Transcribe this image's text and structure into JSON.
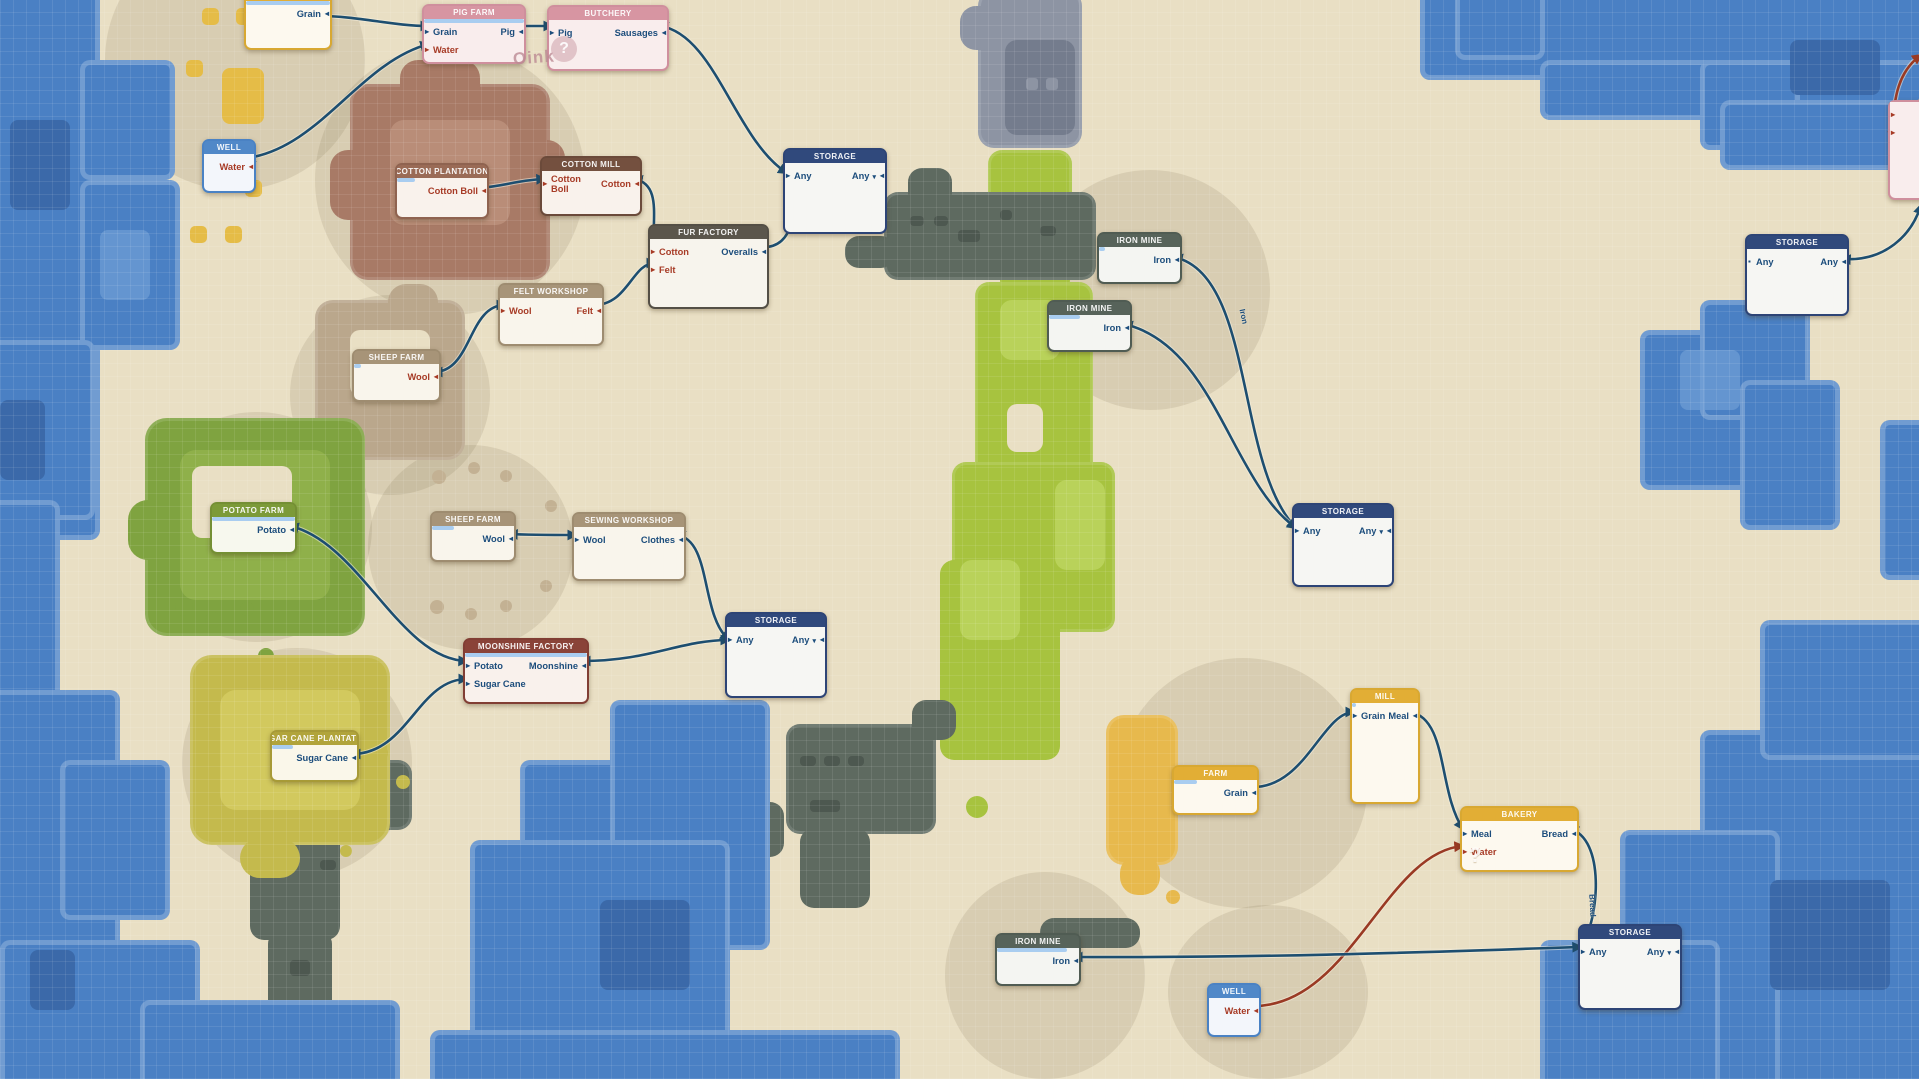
{
  "easter_egg": {
    "oink_text": "Oink",
    "oink_mark": "?"
  },
  "colors": {
    "line_navy": "#1d4e70",
    "line_red": "#9a3a24",
    "item_navy": "#1c4d7c",
    "item_red": "#a73b26",
    "progress": "#a9cdf0",
    "water": "#4a80c4",
    "land": "#e9dfc4",
    "themes": {
      "yellow": {
        "header": "#e2ae35",
        "border": "#d8a832",
        "body": "#fdf9ef"
      },
      "rose": {
        "header": "#d795a2",
        "border": "#cf8f9d",
        "body": "#f9eded"
      },
      "blue": {
        "header": "#5088c8",
        "border": "#4a82c4",
        "body": "#f3f6fb"
      },
      "brown": {
        "header": "#9a6b56",
        "border": "#8f6350",
        "body": "#f9f2ec"
      },
      "darkbrown": {
        "header": "#74503f",
        "border": "#6b4a3a",
        "body": "#f9f2ec"
      },
      "taupe": {
        "header": "#5b564c",
        "border": "#544f46",
        "body": "#f7f4ed"
      },
      "tan": {
        "header": "#a79478",
        "border": "#9e8c70",
        "body": "#f9f5ec"
      },
      "storage": {
        "header": "#30497c",
        "border": "#2d4476",
        "body": "#f6f6f3"
      },
      "iron": {
        "header": "#57635a",
        "border": "#505c53",
        "body": "#f4f5f2"
      },
      "olive": {
        "header": "#7c9a38",
        "border": "#748f34",
        "body": "#f7f8ee"
      },
      "maroon": {
        "header": "#8a4338",
        "border": "#813e34",
        "body": "#f9f1ec"
      },
      "gold": {
        "header": "#b1a43b",
        "border": "#a79a37",
        "body": "#faf7ea"
      }
    }
  },
  "nodes": [
    {
      "id": "farm-top",
      "title": "FARM",
      "theme": "yellow",
      "x": 244,
      "y": -14,
      "w": 84,
      "h": 60,
      "progress": 1,
      "rows": [
        {
          "out": {
            "label": "Grain",
            "color": "navy"
          }
        }
      ]
    },
    {
      "id": "pig-farm",
      "title": "PIG FARM",
      "theme": "rose",
      "x": 422,
      "y": 4,
      "w": 100,
      "h": 56,
      "progress": 1,
      "rows": [
        {
          "in": {
            "label": "Grain",
            "color": "navy"
          },
          "out": {
            "label": "Pig",
            "color": "navy"
          }
        },
        {
          "in": {
            "label": "Water",
            "color": "red"
          }
        }
      ]
    },
    {
      "id": "butchery",
      "title": "BUTCHERY",
      "theme": "rose",
      "x": 547,
      "y": 5,
      "w": 118,
      "h": 62,
      "rows": [
        {
          "in": {
            "label": "Pig",
            "color": "navy"
          },
          "out": {
            "label": "Sausages",
            "color": "navy"
          }
        }
      ]
    },
    {
      "id": "well-top",
      "title": "WELL",
      "theme": "blue",
      "x": 202,
      "y": 139,
      "w": 50,
      "h": 50,
      "rows": [
        {
          "out": {
            "label": "Water",
            "color": "red"
          }
        }
      ]
    },
    {
      "id": "cotton-plantation",
      "title": "COTTON PLANTATION",
      "theme": "brown",
      "x": 395,
      "y": 163,
      "w": 90,
      "h": 52,
      "progress": 0.2,
      "rows": [
        {
          "out": {
            "label": "Cotton Boll",
            "color": "red"
          }
        }
      ]
    },
    {
      "id": "cotton-mill",
      "title": "COTTON MILL",
      "theme": "darkbrown",
      "x": 540,
      "y": 156,
      "w": 98,
      "h": 56,
      "rows": [
        {
          "in": {
            "label": "Cotton Boll",
            "color": "red"
          },
          "out": {
            "label": "Cotton",
            "color": "red"
          }
        }
      ]
    },
    {
      "id": "fur-factory",
      "title": "FUR FACTORY",
      "theme": "taupe",
      "x": 648,
      "y": 224,
      "w": 117,
      "h": 81,
      "rows": [
        {
          "in": {
            "label": "Cotton",
            "color": "red"
          },
          "out": {
            "label": "Overalls",
            "color": "navy"
          }
        },
        {
          "in": {
            "label": "Felt",
            "color": "red"
          }
        }
      ]
    },
    {
      "id": "felt-workshop",
      "title": "FELT WORKSHOP",
      "theme": "tan",
      "x": 498,
      "y": 283,
      "w": 102,
      "h": 59,
      "rows": [
        {
          "in": {
            "label": "Wool",
            "color": "red"
          },
          "out": {
            "label": "Felt",
            "color": "red"
          }
        }
      ]
    },
    {
      "id": "sheep-farm-1",
      "title": "SHEEP FARM",
      "theme": "tan",
      "x": 352,
      "y": 349,
      "w": 85,
      "h": 49,
      "progress": 0.08,
      "rows": [
        {
          "out": {
            "label": "Wool",
            "color": "red"
          }
        }
      ]
    },
    {
      "id": "storage-top",
      "title": "STORAGE",
      "theme": "storage",
      "x": 783,
      "y": 148,
      "w": 100,
      "h": 82,
      "rows": [
        {
          "in": {
            "label": "Any",
            "color": "navy"
          },
          "out": {
            "label": "Any",
            "color": "navy",
            "dropdown": true
          }
        }
      ]
    },
    {
      "id": "iron-mine-1",
      "title": "IRON MINE",
      "theme": "iron",
      "x": 1097,
      "y": 232,
      "w": 81,
      "h": 48,
      "progress": 0.07,
      "rows": [
        {
          "out": {
            "label": "Iron",
            "color": "navy"
          }
        }
      ]
    },
    {
      "id": "iron-mine-2",
      "title": "IRON MINE",
      "theme": "iron",
      "x": 1047,
      "y": 300,
      "w": 81,
      "h": 48,
      "progress": 0.38,
      "rows": [
        {
          "out": {
            "label": "Iron",
            "color": "navy"
          }
        }
      ]
    },
    {
      "id": "storage-right",
      "title": "STORAGE",
      "theme": "storage",
      "x": 1292,
      "y": 503,
      "w": 98,
      "h": 80,
      "rows": [
        {
          "in": {
            "label": "Any",
            "color": "navy"
          },
          "out": {
            "label": "Any",
            "color": "navy",
            "dropdown": true
          }
        }
      ]
    },
    {
      "id": "storage-far-right",
      "title": "STORAGE",
      "theme": "storage",
      "x": 1745,
      "y": 234,
      "w": 100,
      "h": 78,
      "rows": [
        {
          "in": {
            "label": "Any",
            "color": "navy",
            "bullet": "square"
          },
          "out": {
            "label": "Any",
            "color": "navy"
          }
        }
      ]
    },
    {
      "id": "potato-farm",
      "title": "POTATO FARM",
      "theme": "olive",
      "x": 210,
      "y": 502,
      "w": 83,
      "h": 48,
      "progress": 1,
      "rows": [
        {
          "out": {
            "label": "Potato",
            "color": "navy"
          }
        }
      ]
    },
    {
      "id": "sheep-farm-2",
      "title": "SHEEP FARM",
      "theme": "tan",
      "x": 430,
      "y": 511,
      "w": 82,
      "h": 47,
      "progress": 0.27,
      "rows": [
        {
          "out": {
            "label": "Wool",
            "color": "navy"
          }
        }
      ]
    },
    {
      "id": "sewing-workshop",
      "title": "SEWING WORKSHOP",
      "theme": "tan",
      "x": 572,
      "y": 512,
      "w": 110,
      "h": 65,
      "rows": [
        {
          "in": {
            "label": "Wool",
            "color": "navy"
          },
          "out": {
            "label": "Clothes",
            "color": "navy"
          }
        }
      ]
    },
    {
      "id": "moonshine-factory",
      "title": "MOONSHINE FACTORY",
      "theme": "maroon",
      "x": 463,
      "y": 638,
      "w": 122,
      "h": 62,
      "progress": 1,
      "rows": [
        {
          "in": {
            "label": "Potato",
            "color": "navy"
          },
          "out": {
            "label": "Moonshine",
            "color": "navy"
          }
        },
        {
          "in": {
            "label": "Sugar Cane",
            "color": "navy"
          }
        }
      ]
    },
    {
      "id": "sugar-cane-plantation",
      "title": "SUGAR CANE PLANTATION",
      "theme": "gold",
      "x": 270,
      "y": 730,
      "w": 85,
      "h": 48,
      "progress": 0.25,
      "rows": [
        {
          "out": {
            "label": "Sugar Cane",
            "color": "navy"
          }
        }
      ]
    },
    {
      "id": "storage-center",
      "title": "STORAGE",
      "theme": "storage",
      "x": 725,
      "y": 612,
      "w": 98,
      "h": 82,
      "rows": [
        {
          "in": {
            "label": "Any",
            "color": "navy"
          },
          "out": {
            "label": "Any",
            "color": "navy",
            "dropdown": true
          }
        }
      ]
    },
    {
      "id": "mill",
      "title": "MILL",
      "theme": "yellow",
      "x": 1350,
      "y": 688,
      "w": 66,
      "h": 112,
      "progress": 0.06,
      "rows": [
        {
          "in": {
            "label": "Grain",
            "color": "navy"
          },
          "out": {
            "label": "Meal",
            "color": "navy"
          }
        }
      ]
    },
    {
      "id": "farm-bottom",
      "title": "FARM",
      "theme": "yellow",
      "x": 1172,
      "y": 765,
      "w": 83,
      "h": 46,
      "progress": 0.28,
      "rows": [
        {
          "out": {
            "label": "Grain",
            "color": "navy"
          }
        }
      ]
    },
    {
      "id": "bakery",
      "title": "BAKERY",
      "theme": "yellow",
      "x": 1460,
      "y": 806,
      "w": 115,
      "h": 62,
      "ghost": "?",
      "rows": [
        {
          "in": {
            "label": "Meal",
            "color": "navy"
          },
          "out": {
            "label": "Bread",
            "color": "navy"
          }
        },
        {
          "in": {
            "label": "Water",
            "color": "red"
          }
        }
      ]
    },
    {
      "id": "storage-bottom-right",
      "title": "STORAGE",
      "theme": "storage",
      "x": 1578,
      "y": 924,
      "w": 100,
      "h": 82,
      "rows": [
        {
          "in": {
            "label": "Any",
            "color": "navy"
          },
          "out": {
            "label": "Any",
            "color": "navy",
            "dropdown": true
          }
        }
      ]
    },
    {
      "id": "iron-mine-3",
      "title": "IRON MINE",
      "theme": "iron",
      "x": 995,
      "y": 933,
      "w": 82,
      "h": 49,
      "progress": 0.85,
      "rows": [
        {
          "out": {
            "label": "Iron",
            "color": "navy"
          }
        }
      ]
    },
    {
      "id": "well-bottom",
      "title": "WELL",
      "theme": "blue",
      "x": 1207,
      "y": 983,
      "w": 50,
      "h": 50,
      "rows": [
        {
          "out": {
            "label": "Water",
            "color": "red"
          }
        }
      ]
    },
    {
      "id": "edge-node",
      "title": "",
      "theme": "rose",
      "x": 1888,
      "y": 100,
      "w": 64,
      "h": 96,
      "rows": [
        {
          "in": {
            "label": "",
            "color": "red"
          }
        },
        {
          "in": {
            "label": "",
            "color": "red"
          }
        }
      ]
    }
  ],
  "connections": [
    {
      "id": "farm-grain-to-pigfarm",
      "from": [
        318,
        16
      ],
      "c1": [
        360,
        16
      ],
      "c2": [
        392,
        26
      ],
      "to": [
        429,
        26
      ],
      "color": "navy"
    },
    {
      "id": "well-water-to-pigfarm",
      "from": [
        247,
        158
      ],
      "c1": [
        320,
        148
      ],
      "c2": [
        360,
        62
      ],
      "to": [
        429,
        44
      ],
      "color": "navy"
    },
    {
      "id": "pig-to-butchery",
      "from": [
        517,
        26
      ],
      "c1": [
        530,
        26
      ],
      "c2": [
        540,
        26
      ],
      "to": [
        552,
        26
      ],
      "color": "navy"
    },
    {
      "id": "sausages-to-storage",
      "from": [
        660,
        26
      ],
      "c1": [
        715,
        34
      ],
      "c2": [
        735,
        140
      ],
      "to": [
        787,
        173
      ],
      "color": "navy"
    },
    {
      "id": "cottonboll-to-mill",
      "from": [
        479,
        188
      ],
      "c1": [
        505,
        186
      ],
      "c2": [
        518,
        180
      ],
      "to": [
        545,
        179
      ],
      "color": "navy"
    },
    {
      "id": "cotton-to-furfactory",
      "from": [
        634,
        179
      ],
      "c1": [
        664,
        184
      ],
      "c2": [
        650,
        225
      ],
      "to": [
        655,
        247
      ],
      "color": "navy"
    },
    {
      "id": "felt-to-furfactory",
      "from": [
        594,
        305
      ],
      "c1": [
        628,
        305
      ],
      "c2": [
        632,
        263
      ],
      "to": [
        655,
        263
      ],
      "color": "navy"
    },
    {
      "id": "wool-to-feltworkshop",
      "from": [
        434,
        372
      ],
      "c1": [
        472,
        372
      ],
      "c2": [
        468,
        305
      ],
      "to": [
        505,
        305
      ],
      "color": "navy"
    },
    {
      "id": "overalls-to-storage",
      "from": [
        760,
        247
      ],
      "c1": [
        797,
        250
      ],
      "c2": [
        797,
        203
      ],
      "to": [
        788,
        176
      ],
      "color": "navy"
    },
    {
      "id": "wool-to-sewing",
      "from": [
        509,
        534
      ],
      "c1": [
        530,
        535
      ],
      "c2": [
        550,
        535
      ],
      "to": [
        576,
        535
      ],
      "color": "navy"
    },
    {
      "id": "potato-to-moonshine",
      "from": [
        290,
        526
      ],
      "c1": [
        360,
        542
      ],
      "c2": [
        400,
        660
      ],
      "to": [
        467,
        661
      ],
      "color": "navy"
    },
    {
      "id": "sugarcane-to-moonshine",
      "from": [
        352,
        754
      ],
      "c1": [
        408,
        754
      ],
      "c2": [
        418,
        679
      ],
      "to": [
        467,
        679
      ],
      "color": "navy"
    },
    {
      "id": "moonshine-to-storage",
      "from": [
        582,
        661
      ],
      "c1": [
        650,
        661
      ],
      "c2": [
        680,
        640
      ],
      "to": [
        729,
        640
      ],
      "color": "navy"
    },
    {
      "id": "clothes-to-storage",
      "from": [
        677,
        535
      ],
      "c1": [
        712,
        540
      ],
      "c2": [
        700,
        615
      ],
      "to": [
        729,
        640
      ],
      "color": "navy"
    },
    {
      "id": "iron1-to-storage",
      "from": [
        1174,
        257
      ],
      "c1": [
        1255,
        275
      ],
      "c2": [
        1235,
        465
      ],
      "to": [
        1296,
        528
      ],
      "color": "navy"
    },
    {
      "id": "iron2-to-storage",
      "from": [
        1124,
        324
      ],
      "c1": [
        1215,
        345
      ],
      "c2": [
        1230,
        480
      ],
      "to": [
        1296,
        528
      ],
      "color": "navy"
    },
    {
      "id": "grain-to-mill",
      "from": [
        1250,
        787
      ],
      "c1": [
        1305,
        790
      ],
      "c2": [
        1322,
        712
      ],
      "to": [
        1354,
        712
      ],
      "color": "navy"
    },
    {
      "id": "meal-to-bakery",
      "from": [
        1410,
        712
      ],
      "c1": [
        1448,
        718
      ],
      "c2": [
        1438,
        792
      ],
      "to": [
        1463,
        829
      ],
      "color": "navy"
    },
    {
      "id": "bread-to-storage",
      "from": [
        1570,
        829
      ],
      "c1": [
        1605,
        838
      ],
      "c2": [
        1600,
        918
      ],
      "to": [
        1581,
        947
      ],
      "color": "navy"
    },
    {
      "id": "water-to-bakery",
      "from": [
        1252,
        1006
      ],
      "c1": [
        1350,
        1008
      ],
      "c2": [
        1385,
        852
      ],
      "to": [
        1463,
        846
      ],
      "color": "red"
    },
    {
      "id": "iron3-to-storage",
      "from": [
        1074,
        957
      ],
      "c1": [
        1300,
        958
      ],
      "c2": [
        1480,
        950
      ],
      "to": [
        1581,
        947
      ],
      "color": "navy"
    },
    {
      "id": "storage-any-out",
      "from": [
        1842,
        259
      ],
      "c1": [
        1885,
        262
      ],
      "c2": [
        1912,
        235
      ],
      "to": [
        1921,
        205
      ],
      "color": "navy"
    },
    {
      "id": "edge-stub-1",
      "from": [
        1921,
        55
      ],
      "c1": [
        1900,
        70
      ],
      "c2": [
        1892,
        95
      ],
      "to": [
        1893,
        140
      ],
      "color": "red"
    },
    {
      "id": "edge-stub-2",
      "from": [
        1921,
        100
      ],
      "c1": [
        1905,
        115
      ],
      "c2": [
        1896,
        135
      ],
      "to": [
        1893,
        166
      ],
      "color": "red"
    }
  ],
  "line_labels": [
    {
      "text": "Iron",
      "x": 1236,
      "y": 312,
      "rot": 78
    },
    {
      "text": "Bread",
      "x": 1581,
      "y": 901,
      "rot": 87
    }
  ]
}
